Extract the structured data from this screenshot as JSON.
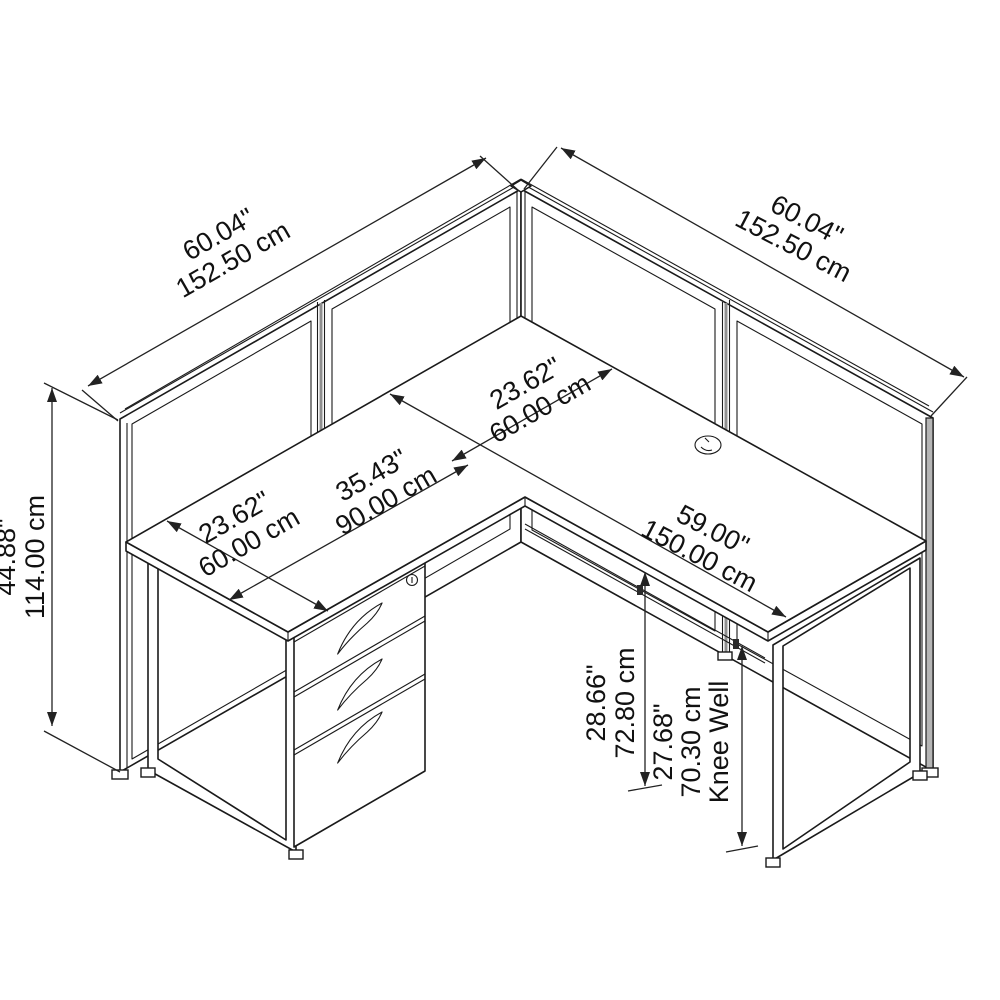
{
  "drawing": {
    "type": "isometric-dimension-drawing",
    "subject": "L-shaped cubicle desk with privacy panels, 3-drawer mobile pedestal and O-leg frames",
    "units": [
      "inches",
      "centimeters"
    ],
    "dims": {
      "left_panel_w": {
        "in": "60.04\"",
        "cm": "152.50 cm"
      },
      "right_panel_w": {
        "in": "60.04\"",
        "cm": "152.50 cm"
      },
      "main_desk_depth": {
        "in": "23.62\"",
        "cm": "60.00 cm"
      },
      "return_desk_length": {
        "in": "35.43\"",
        "cm": "90.00 cm"
      },
      "return_desk_depth": {
        "in": "23.62\"",
        "cm": "60.00 cm"
      },
      "main_desk_length": {
        "in": "59.00\"",
        "cm": "150.00 cm"
      },
      "panel_height": {
        "in": "44.88\"",
        "cm": "114.00 cm"
      },
      "desk_surface_height": {
        "in": "28.66\"",
        "cm": "72.80 cm"
      },
      "knee_well_height": {
        "in": "27.68\"",
        "cm": "70.30 cm",
        "label": "Knee Well"
      }
    }
  }
}
